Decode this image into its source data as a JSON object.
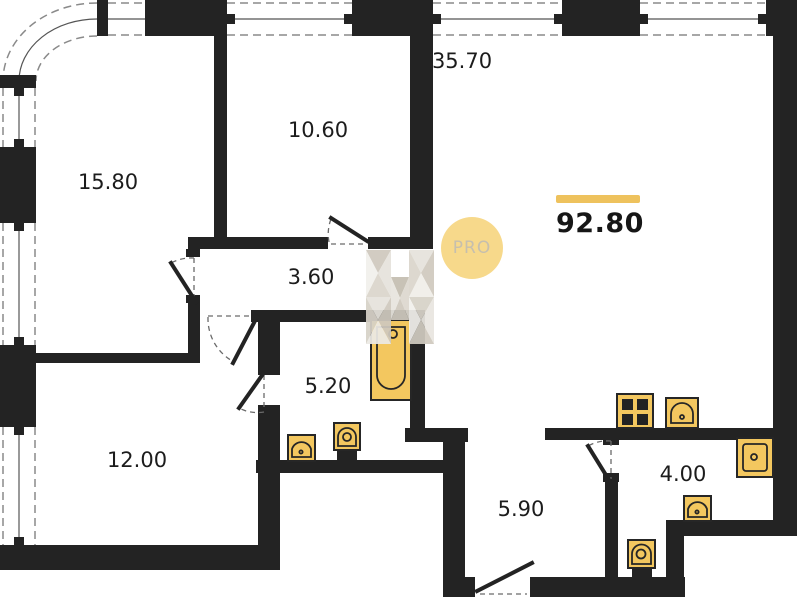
{
  "plan": {
    "title": "apartment-floor-plan",
    "total_area": "92.80",
    "watermark_badge": "PRO",
    "rooms": [
      {
        "name": "living-room-kitchen",
        "area": "35.70"
      },
      {
        "name": "bedroom-top-left",
        "area": "15.80"
      },
      {
        "name": "room-top-middle",
        "area": "10.60"
      },
      {
        "name": "hallway",
        "area": "3.60"
      },
      {
        "name": "bathroom",
        "area": "5.20"
      },
      {
        "name": "bedroom-bottom-left",
        "area": "12.00"
      },
      {
        "name": "corridor",
        "area": "5.90"
      },
      {
        "name": "wc",
        "area": "4.00"
      }
    ],
    "fixtures": [
      "bathtub",
      "washbasin",
      "toilet",
      "stove",
      "kitchen-sink",
      "wall-sink",
      "washbasin",
      "toilet"
    ],
    "colors": {
      "wall": "#232323",
      "fixture_fill": "#f3c75f",
      "accent_bar": "#eec25d",
      "pro_badge_bg": "#f7d98b",
      "pro_badge_text": "#c6bfae"
    }
  }
}
